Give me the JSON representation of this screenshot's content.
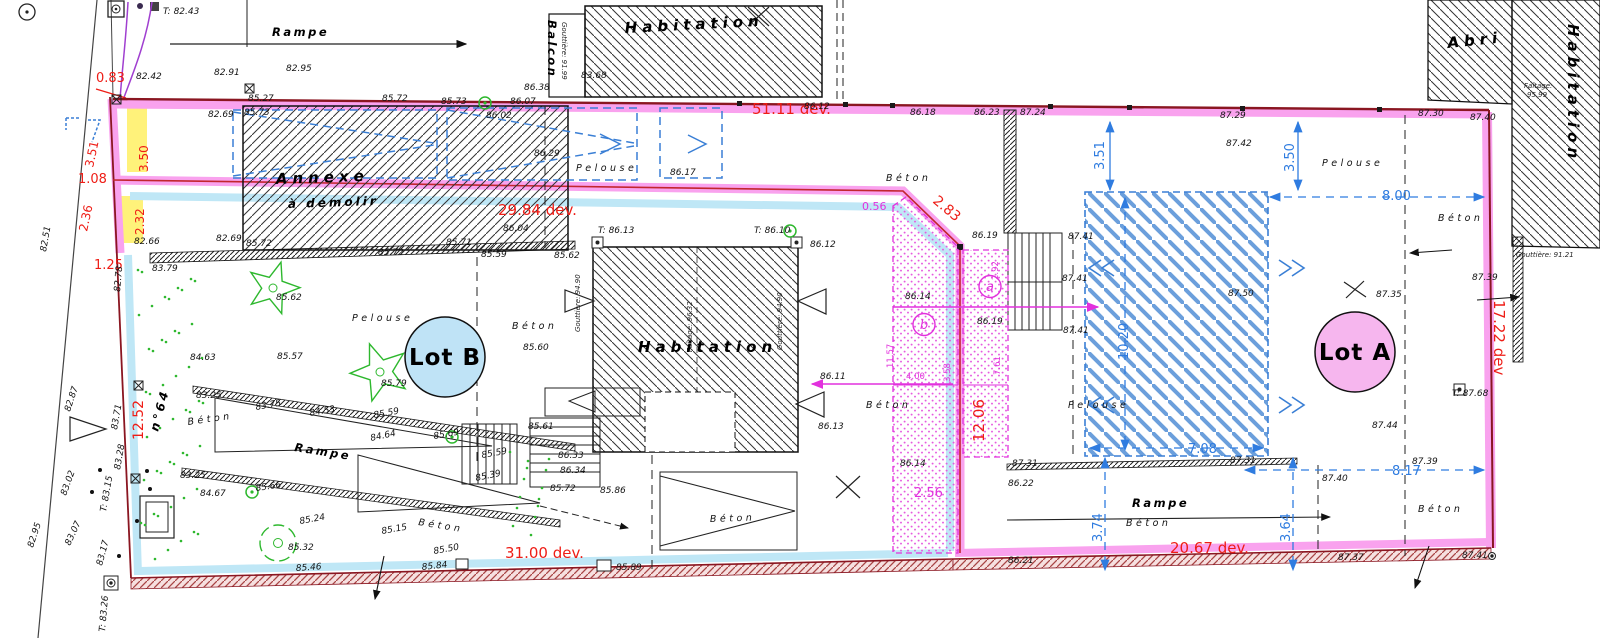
{
  "lots": {
    "a": "Lot A",
    "b": "Lot B"
  },
  "colors": {
    "boundary_red": "#8a1621",
    "pink_band": "#f9a2ee",
    "cyan_band": "#bfe7f6",
    "magenta": "#e231dd",
    "blue_dim": "#2f7ce0",
    "red_dim": "#ee1d16",
    "green": "#2eb82e",
    "yellow": "#fff27a",
    "lot_a_fill": "#f6b6ee",
    "lot_b_fill": "#bfe3f6"
  },
  "labels": [
    {
      "x": 163,
      "y": 14,
      "t": "T: 82.43",
      "c": "e"
    },
    {
      "x": 272,
      "y": 36,
      "t": "Rampe",
      "c": "nameS"
    },
    {
      "x": 96,
      "y": 82,
      "t": "0.83",
      "c": "red",
      "s": 13
    },
    {
      "x": 136,
      "y": 79,
      "t": "82.42",
      "c": "e"
    },
    {
      "x": 214,
      "y": 75,
      "t": "82.91",
      "c": "e"
    },
    {
      "x": 286,
      "y": 71,
      "t": "82.95",
      "c": "e"
    },
    {
      "x": 248,
      "y": 101,
      "t": "85.27",
      "c": "e"
    },
    {
      "x": 208,
      "y": 117,
      "t": "82.69",
      "c": "e"
    },
    {
      "x": 244,
      "y": 115,
      "t": "85.73",
      "c": "e"
    },
    {
      "x": 382,
      "y": 101,
      "t": "85.72",
      "c": "e"
    },
    {
      "x": 441,
      "y": 104,
      "t": "85.73",
      "c": "e"
    },
    {
      "x": 510,
      "y": 104,
      "t": "86.07",
      "c": "e"
    },
    {
      "x": 486,
      "y": 118,
      "t": "86.02",
      "c": "e"
    },
    {
      "x": 524,
      "y": 90,
      "t": "86.38",
      "c": "e"
    },
    {
      "x": 581,
      "y": 78,
      "t": "83.68",
      "c": "e"
    },
    {
      "x": 548,
      "y": 20,
      "t": "Balcon",
      "c": "nameS",
      "r": 90
    },
    {
      "x": 562,
      "y": 22,
      "t": "Gouttière: 91.99",
      "c": "tiny",
      "r": 90
    },
    {
      "x": 625,
      "y": 33,
      "t": "Habitation",
      "c": "name",
      "r": -3
    },
    {
      "x": 752,
      "y": 114,
      "t": "51.11 dev.",
      "c": "redL"
    },
    {
      "x": 804,
      "y": 109,
      "t": "86.12",
      "c": "e"
    },
    {
      "x": 910,
      "y": 115,
      "t": "86.18",
      "c": "e"
    },
    {
      "x": 974,
      "y": 115,
      "t": "86.23",
      "c": "e"
    },
    {
      "x": 1020,
      "y": 115,
      "t": "87.24",
      "c": "e"
    },
    {
      "x": 1220,
      "y": 118,
      "t": "87.29",
      "c": "e"
    },
    {
      "x": 1226,
      "y": 146,
      "t": "87.42",
      "c": "e"
    },
    {
      "x": 1418,
      "y": 116,
      "t": "87.30",
      "c": "e"
    },
    {
      "x": 1470,
      "y": 120,
      "t": "87.40",
      "c": "e"
    },
    {
      "x": 1448,
      "y": 48,
      "t": "Abri",
      "c": "name",
      "r": -6
    },
    {
      "x": 1568,
      "y": 24,
      "t": "Habitation",
      "c": "name",
      "r": 90
    },
    {
      "x": 1524,
      "y": 88,
      "t": "Faîtage:",
      "c": "tiny"
    },
    {
      "x": 1527,
      "y": 97,
      "t": "95.99",
      "c": "tiny"
    },
    {
      "x": 1104,
      "y": 170,
      "t": "3.51",
      "c": "blue",
      "r": -90
    },
    {
      "x": 1294,
      "y": 172,
      "t": "3.50",
      "c": "blue",
      "r": -90
    },
    {
      "x": 1382,
      "y": 200,
      "t": "8.00",
      "c": "blue"
    },
    {
      "x": 1322,
      "y": 166,
      "t": "Pelouse",
      "c": "area"
    },
    {
      "x": 1438,
      "y": 221,
      "t": "Béton",
      "c": "area"
    },
    {
      "x": 46,
      "y": 252,
      "t": "82.51",
      "c": "e",
      "r": -80
    },
    {
      "x": 93,
      "y": 168,
      "t": "3.51",
      "c": "red",
      "r": -78
    },
    {
      "x": 148,
      "y": 172,
      "t": "3.50",
      "c": "red",
      "r": -90
    },
    {
      "x": 78,
      "y": 183,
      "t": "1.08",
      "c": "red",
      "s": 13
    },
    {
      "x": 87,
      "y": 232,
      "t": "2.36",
      "c": "red",
      "r": -78
    },
    {
      "x": 144,
      "y": 235,
      "t": "2.32",
      "c": "red",
      "r": -90
    },
    {
      "x": 94,
      "y": 269,
      "t": "1.25",
      "c": "red",
      "s": 13
    },
    {
      "x": 120,
      "y": 292,
      "t": "82.78",
      "c": "e",
      "r": -85
    },
    {
      "x": 134,
      "y": 244,
      "t": "82.66",
      "c": "e"
    },
    {
      "x": 216,
      "y": 241,
      "t": "82.69",
      "c": "e"
    },
    {
      "x": 246,
      "y": 246,
      "t": "85.72",
      "c": "e"
    },
    {
      "x": 152,
      "y": 271,
      "t": "83.79",
      "c": "e"
    },
    {
      "x": 276,
      "y": 184,
      "t": "Annexe",
      "c": "name",
      "r": -2
    },
    {
      "x": 288,
      "y": 208,
      "t": "à démolir",
      "c": "nameM",
      "r": -2
    },
    {
      "x": 378,
      "y": 255,
      "t": "85.72",
      "c": "e"
    },
    {
      "x": 534,
      "y": 156,
      "t": "86.29",
      "c": "e"
    },
    {
      "x": 576,
      "y": 171,
      "t": "Pelouse",
      "c": "area"
    },
    {
      "x": 670,
      "y": 175,
      "t": "86.17",
      "c": "e"
    },
    {
      "x": 498,
      "y": 215,
      "t": "29.84 dev.",
      "c": "redL"
    },
    {
      "x": 503,
      "y": 231,
      "t": "86.04",
      "c": "e"
    },
    {
      "x": 446,
      "y": 245,
      "t": "85.71",
      "c": "e"
    },
    {
      "x": 481,
      "y": 257,
      "t": "85.59",
      "c": "e"
    },
    {
      "x": 554,
      "y": 258,
      "t": "85.62",
      "c": "e"
    },
    {
      "x": 598,
      "y": 233,
      "t": "T: 86.13",
      "c": "e"
    },
    {
      "x": 754,
      "y": 233,
      "t": "T: 86.10",
      "c": "e"
    },
    {
      "x": 810,
      "y": 247,
      "t": "86.12",
      "c": "e"
    },
    {
      "x": 886,
      "y": 181,
      "t": "Béton",
      "c": "area"
    },
    {
      "x": 862,
      "y": 210,
      "t": "0.56",
      "c": "mag"
    },
    {
      "x": 932,
      "y": 202,
      "t": "2.83",
      "c": "red",
      "r": 40,
      "s": 14
    },
    {
      "x": 972,
      "y": 238,
      "t": "86.19",
      "c": "e"
    },
    {
      "x": 905,
      "y": 299,
      "t": "86.14",
      "c": "e"
    },
    {
      "x": 977,
      "y": 324,
      "t": "86.19",
      "c": "e"
    },
    {
      "x": 900,
      "y": 466,
      "t": "86.14",
      "c": "e"
    },
    {
      "x": 580,
      "y": 332,
      "t": "Gouttière: 94.90",
      "c": "tiny",
      "r": -90
    },
    {
      "x": 692,
      "y": 352,
      "t": "Faîtage: 96.32",
      "c": "tiny",
      "r": -90
    },
    {
      "x": 782,
      "y": 350,
      "t": "Gouttière: 94.90",
      "c": "tiny",
      "r": -90
    },
    {
      "x": 638,
      "y": 352,
      "t": "Habitation",
      "c": "name"
    },
    {
      "x": 512,
      "y": 329,
      "t": "Béton",
      "c": "area"
    },
    {
      "x": 523,
      "y": 350,
      "t": "85.60",
      "c": "e"
    },
    {
      "x": 352,
      "y": 321,
      "t": "Pelouse",
      "c": "area"
    },
    {
      "x": 276,
      "y": 300,
      "t": "85.62",
      "c": "e"
    },
    {
      "x": 277,
      "y": 359,
      "t": "85.57",
      "c": "e"
    },
    {
      "x": 381,
      "y": 386,
      "t": "85.79",
      "c": "e"
    },
    {
      "x": 820,
      "y": 379,
      "t": "86.11",
      "c": "e"
    },
    {
      "x": 818,
      "y": 429,
      "t": "86.13",
      "c": "e"
    },
    {
      "x": 866,
      "y": 408,
      "t": "Béton",
      "c": "area"
    },
    {
      "x": 906,
      "y": 379,
      "t": "4.00",
      "c": "mag9"
    },
    {
      "x": 893,
      "y": 368,
      "t": "11.57",
      "c": "mag9",
      "r": -90
    },
    {
      "x": 950,
      "y": 382,
      "t": "3.58",
      "c": "mag9",
      "r": -90
    },
    {
      "x": 1000,
      "y": 375,
      "t": "7.61",
      "c": "mag9",
      "r": -90
    },
    {
      "x": 998,
      "y": 280,
      "t": "2.92",
      "c": "mag9",
      "r": -90
    },
    {
      "x": 914,
      "y": 497,
      "t": "2.56",
      "c": "mag",
      "s": 13
    },
    {
      "x": 984,
      "y": 442,
      "t": "12.06",
      "c": "redL",
      "r": -90
    },
    {
      "x": 990,
      "y": 291,
      "t": "a",
      "c": "magC"
    },
    {
      "x": 924,
      "y": 329,
      "t": "b",
      "c": "magC"
    },
    {
      "x": 1068,
      "y": 239,
      "t": "87.41",
      "c": "e"
    },
    {
      "x": 1062,
      "y": 281,
      "t": "87.41",
      "c": "e"
    },
    {
      "x": 1063,
      "y": 333,
      "t": "87.41",
      "c": "e"
    },
    {
      "x": 1228,
      "y": 296,
      "t": "87.50",
      "c": "e"
    },
    {
      "x": 1376,
      "y": 297,
      "t": "87.35",
      "c": "e"
    },
    {
      "x": 1128,
      "y": 360,
      "t": "10.20",
      "c": "blue",
      "r": -90
    },
    {
      "x": 1068,
      "y": 408,
      "t": "Pelouse",
      "c": "area"
    },
    {
      "x": 1372,
      "y": 428,
      "t": "87.44",
      "c": "e"
    },
    {
      "x": 1188,
      "y": 453,
      "t": "7.08",
      "c": "blue"
    },
    {
      "x": 1230,
      "y": 463,
      "t": "87.31",
      "c": "e"
    },
    {
      "x": 1392,
      "y": 475,
      "t": "8.17",
      "c": "blue"
    },
    {
      "x": 1412,
      "y": 464,
      "t": "87.39",
      "c": "e"
    },
    {
      "x": 1494,
      "y": 300,
      "t": "17.22 dev",
      "c": "redL",
      "r": 90
    },
    {
      "x": 1452,
      "y": 396,
      "t": "T: 87.68",
      "c": "e"
    },
    {
      "x": 1472,
      "y": 280,
      "t": "87.39",
      "c": "e"
    },
    {
      "x": 1516,
      "y": 257,
      "t": "Gouttière: 91.21",
      "c": "tiny"
    },
    {
      "x": 70,
      "y": 412,
      "t": "82.87",
      "c": "e",
      "r": -72
    },
    {
      "x": 117,
      "y": 430,
      "t": "83.71",
      "c": "e",
      "r": -80
    },
    {
      "x": 120,
      "y": 470,
      "t": "83.28",
      "c": "e",
      "r": -80
    },
    {
      "x": 66,
      "y": 496,
      "t": "83.02",
      "c": "e",
      "r": -70
    },
    {
      "x": 106,
      "y": 512,
      "t": "T: 83.15",
      "c": "e",
      "r": -80
    },
    {
      "x": 70,
      "y": 546,
      "t": "83.07",
      "c": "e",
      "r": -65
    },
    {
      "x": 102,
      "y": 566,
      "t": "83.17",
      "c": "e",
      "r": -75
    },
    {
      "x": 105,
      "y": 632,
      "t": "T: 83.26",
      "c": "e",
      "r": -85
    },
    {
      "x": 33,
      "y": 548,
      "t": "82.95",
      "c": "e",
      "r": -72
    },
    {
      "x": 143,
      "y": 440,
      "t": "12.52",
      "c": "red",
      "r": -90,
      "s": 14
    },
    {
      "x": 158,
      "y": 432,
      "t": "n°64",
      "c": "nameM",
      "r": -75
    },
    {
      "x": 196,
      "y": 398,
      "t": "83.25",
      "c": "e"
    },
    {
      "x": 256,
      "y": 410,
      "t": "83.75",
      "c": "e",
      "r": -10
    },
    {
      "x": 190,
      "y": 360,
      "t": "84.63",
      "c": "e"
    },
    {
      "x": 180,
      "y": 478,
      "t": "83.25",
      "c": "e"
    },
    {
      "x": 200,
      "y": 496,
      "t": "84.67",
      "c": "e"
    },
    {
      "x": 256,
      "y": 491,
      "t": "85.66",
      "c": "e",
      "r": -8
    },
    {
      "x": 300,
      "y": 524,
      "t": "85.24",
      "c": "e",
      "r": -10
    },
    {
      "x": 288,
      "y": 550,
      "t": "85.32",
      "c": "e"
    },
    {
      "x": 188,
      "y": 425,
      "t": "Béton",
      "c": "area",
      "r": -8
    },
    {
      "x": 294,
      "y": 451,
      "t": "Rampe",
      "c": "nameS",
      "r": 9
    },
    {
      "x": 310,
      "y": 416,
      "t": "84.53",
      "c": "e",
      "r": -10
    },
    {
      "x": 374,
      "y": 418,
      "t": "85.59",
      "c": "e",
      "r": -10
    },
    {
      "x": 371,
      "y": 441,
      "t": "84.64",
      "c": "e",
      "r": -12
    },
    {
      "x": 434,
      "y": 439,
      "t": "85.69",
      "c": "e",
      "r": -10
    },
    {
      "x": 482,
      "y": 458,
      "t": "85.59",
      "c": "e",
      "r": -10
    },
    {
      "x": 476,
      "y": 481,
      "t": "85.39",
      "c": "e",
      "r": -12
    },
    {
      "x": 382,
      "y": 534,
      "t": "85.15",
      "c": "e",
      "r": -10
    },
    {
      "x": 434,
      "y": 554,
      "t": "85.50",
      "c": "e",
      "r": -10
    },
    {
      "x": 422,
      "y": 570,
      "t": "85.84",
      "c": "e",
      "r": -6
    },
    {
      "x": 296,
      "y": 571,
      "t": "85.46",
      "c": "e",
      "r": -4
    },
    {
      "x": 418,
      "y": 525,
      "t": "Béton",
      "c": "area",
      "r": 9
    },
    {
      "x": 528,
      "y": 429,
      "t": "85.61",
      "c": "e"
    },
    {
      "x": 558,
      "y": 458,
      "t": "86.33",
      "c": "e"
    },
    {
      "x": 560,
      "y": 473,
      "t": "86.34",
      "c": "e"
    },
    {
      "x": 550,
      "y": 491,
      "t": "85.72",
      "c": "e"
    },
    {
      "x": 600,
      "y": 493,
      "t": "85.86",
      "c": "e"
    },
    {
      "x": 505,
      "y": 558,
      "t": "31.00 dev.",
      "c": "redL"
    },
    {
      "x": 616,
      "y": 570,
      "t": "85.89",
      "c": "e"
    },
    {
      "x": 710,
      "y": 522,
      "t": "Béton",
      "c": "area",
      "r": -2
    },
    {
      "x": 1012,
      "y": 466,
      "t": "87.31",
      "c": "e"
    },
    {
      "x": 1008,
      "y": 486,
      "t": "86.22",
      "c": "e"
    },
    {
      "x": 1008,
      "y": 563,
      "t": "86.21",
      "c": "e"
    },
    {
      "x": 1102,
      "y": 542,
      "t": "3.74",
      "c": "blue",
      "r": -90
    },
    {
      "x": 1290,
      "y": 542,
      "t": "3.64",
      "c": "blue",
      "r": -90
    },
    {
      "x": 1132,
      "y": 507,
      "t": "Rampe",
      "c": "nameS"
    },
    {
      "x": 1126,
      "y": 526,
      "t": "Béton",
      "c": "area"
    },
    {
      "x": 1170,
      "y": 553,
      "t": "20.67 dev.",
      "c": "redL"
    },
    {
      "x": 1322,
      "y": 481,
      "t": "87.40",
      "c": "e"
    },
    {
      "x": 1338,
      "y": 560,
      "t": "87.37",
      "c": "e"
    },
    {
      "x": 1462,
      "y": 558,
      "t": "87.41",
      "c": "e"
    },
    {
      "x": 1418,
      "y": 512,
      "t": "Béton",
      "c": "area"
    }
  ]
}
